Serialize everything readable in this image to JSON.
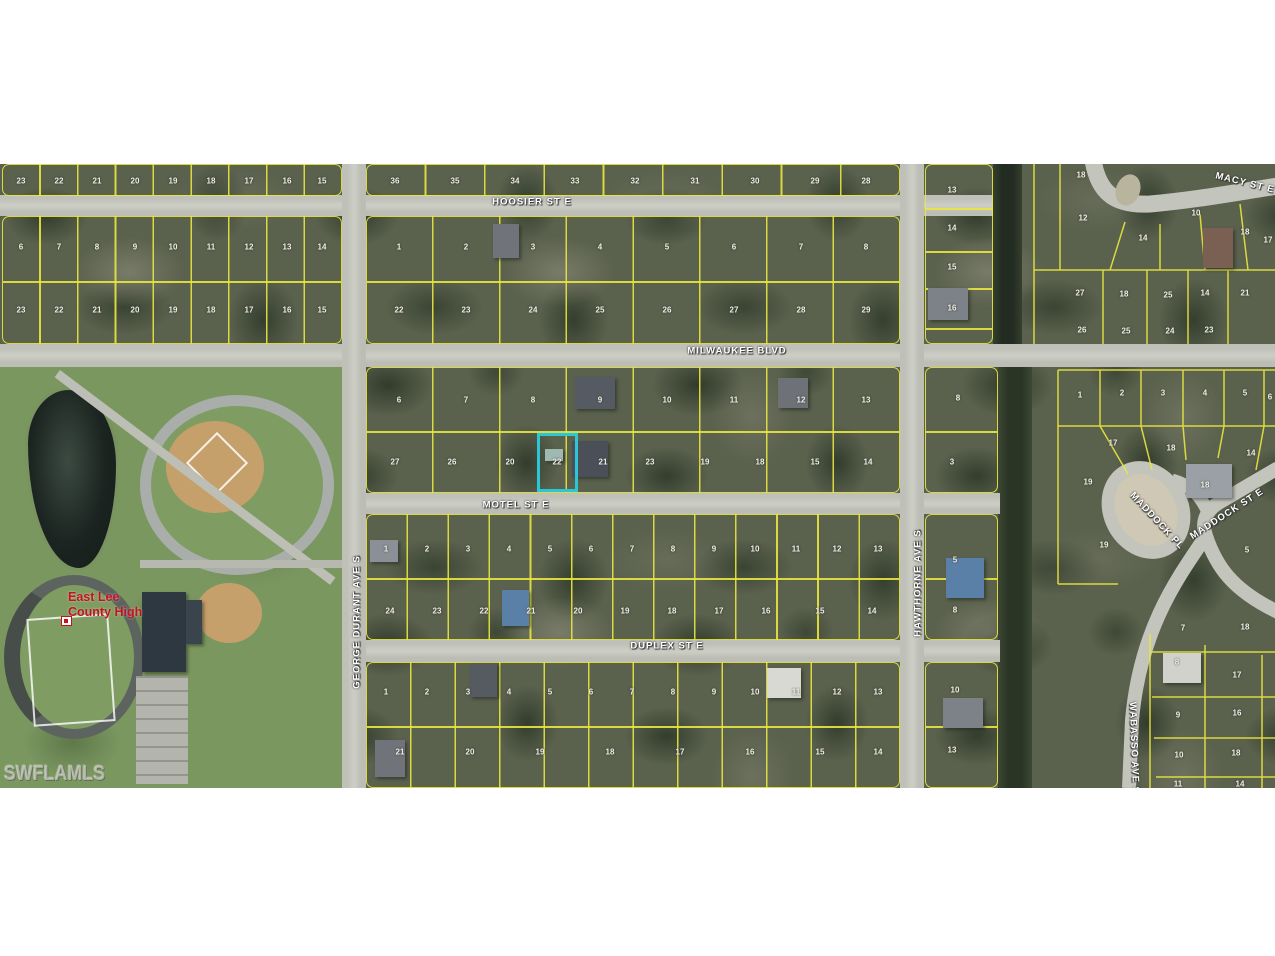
{
  "watermark": "SWFLAMLS",
  "school_label": {
    "line1": "East Lee",
    "line2": "County High"
  },
  "colors": {
    "parcel_line": "#e9e73f",
    "road": "#c3c5bc",
    "highlight": "#2cc7d6",
    "school_label_red": "#c5121f",
    "watermark_gray": "#d6d6d0",
    "scrub_green": "#5a614d",
    "campus_green": "#7b9760",
    "canal_dark": "#222c22"
  },
  "streets": [
    {
      "label": "HOOSIER ST E",
      "x": 532,
      "y": 202,
      "rot": 0
    },
    {
      "label": "MACY ST E",
      "x": 1245,
      "y": 183,
      "rot": 14
    },
    {
      "label": "MILWAUKEE BLVD",
      "x": 737,
      "y": 351,
      "rot": 0
    },
    {
      "label": "MOTEL ST E",
      "x": 516,
      "y": 505,
      "rot": 0
    },
    {
      "label": "DUPLEX ST E",
      "x": 667,
      "y": 646,
      "rot": 0
    },
    {
      "label": "GEORGE DURANT AVE S",
      "x": 357,
      "y": 622,
      "rot": -90
    },
    {
      "label": "HAWTHORNE AVE S",
      "x": 918,
      "y": 583,
      "rot": -90
    },
    {
      "label": "WABASSO AVE S",
      "x": 1134,
      "y": 748,
      "rot": 88
    },
    {
      "label": "MADDOCK PL",
      "x": 1157,
      "y": 521,
      "rot": 47
    },
    {
      "label": "MADDOCK ST E",
      "x": 1227,
      "y": 514,
      "rot": -33
    }
  ],
  "lot_numbers": [
    [
      21,
      181,
      "23"
    ],
    [
      59,
      181,
      "22"
    ],
    [
      97,
      181,
      "21"
    ],
    [
      135,
      181,
      "20"
    ],
    [
      173,
      181,
      "19"
    ],
    [
      211,
      181,
      "18"
    ],
    [
      249,
      181,
      "17"
    ],
    [
      287,
      181,
      "16"
    ],
    [
      322,
      181,
      "15"
    ],
    [
      395,
      181,
      "36"
    ],
    [
      455,
      181,
      "35"
    ],
    [
      515,
      181,
      "34"
    ],
    [
      575,
      181,
      "33"
    ],
    [
      635,
      181,
      "32"
    ],
    [
      695,
      181,
      "31"
    ],
    [
      755,
      181,
      "30"
    ],
    [
      815,
      181,
      "29"
    ],
    [
      866,
      181,
      "28"
    ],
    [
      21,
      247,
      "6"
    ],
    [
      59,
      247,
      "7"
    ],
    [
      97,
      247,
      "8"
    ],
    [
      135,
      247,
      "9"
    ],
    [
      173,
      247,
      "10"
    ],
    [
      211,
      247,
      "11"
    ],
    [
      249,
      247,
      "12"
    ],
    [
      287,
      247,
      "13"
    ],
    [
      322,
      247,
      "14"
    ],
    [
      399,
      247,
      "1"
    ],
    [
      466,
      247,
      "2"
    ],
    [
      533,
      247,
      "3"
    ],
    [
      600,
      247,
      "4"
    ],
    [
      667,
      247,
      "5"
    ],
    [
      734,
      247,
      "6"
    ],
    [
      801,
      247,
      "7"
    ],
    [
      866,
      247,
      "8"
    ],
    [
      21,
      310,
      "23"
    ],
    [
      59,
      310,
      "22"
    ],
    [
      97,
      310,
      "21"
    ],
    [
      135,
      310,
      "20"
    ],
    [
      173,
      310,
      "19"
    ],
    [
      211,
      310,
      "18"
    ],
    [
      249,
      310,
      "17"
    ],
    [
      287,
      310,
      "16"
    ],
    [
      322,
      310,
      "15"
    ],
    [
      399,
      310,
      "22"
    ],
    [
      466,
      310,
      "23"
    ],
    [
      533,
      310,
      "24"
    ],
    [
      600,
      310,
      "25"
    ],
    [
      667,
      310,
      "26"
    ],
    [
      734,
      310,
      "27"
    ],
    [
      801,
      310,
      "28"
    ],
    [
      866,
      310,
      "29"
    ],
    [
      952,
      190,
      "13"
    ],
    [
      952,
      228,
      "14"
    ],
    [
      952,
      267,
      "15"
    ],
    [
      952,
      308,
      "16"
    ],
    [
      1081,
      175,
      "18"
    ],
    [
      1083,
      218,
      "12"
    ],
    [
      1143,
      238,
      "14"
    ],
    [
      1196,
      213,
      "10"
    ],
    [
      1245,
      232,
      "18"
    ],
    [
      1268,
      240,
      "17"
    ],
    [
      1080,
      293,
      "27"
    ],
    [
      1124,
      294,
      "18"
    ],
    [
      1168,
      295,
      "25"
    ],
    [
      1205,
      293,
      "14"
    ],
    [
      1245,
      293,
      "21"
    ],
    [
      1082,
      330,
      "26"
    ],
    [
      1126,
      331,
      "25"
    ],
    [
      1170,
      331,
      "24"
    ],
    [
      1209,
      330,
      "23"
    ],
    [
      399,
      400,
      "6"
    ],
    [
      466,
      400,
      "7"
    ],
    [
      533,
      400,
      "8"
    ],
    [
      600,
      400,
      "9"
    ],
    [
      667,
      400,
      "10"
    ],
    [
      734,
      400,
      "11"
    ],
    [
      801,
      400,
      "12"
    ],
    [
      866,
      400,
      "13"
    ],
    [
      395,
      462,
      "27"
    ],
    [
      452,
      462,
      "26"
    ],
    [
      510,
      462,
      "20"
    ],
    [
      557,
      462,
      "22"
    ],
    [
      603,
      462,
      "21"
    ],
    [
      650,
      462,
      "23"
    ],
    [
      705,
      462,
      "19"
    ],
    [
      760,
      462,
      "18"
    ],
    [
      815,
      462,
      "15"
    ],
    [
      868,
      462,
      "14"
    ],
    [
      958,
      398,
      "8"
    ],
    [
      952,
      462,
      "3"
    ],
    [
      386,
      549,
      "1"
    ],
    [
      427,
      549,
      "2"
    ],
    [
      468,
      549,
      "3"
    ],
    [
      509,
      549,
      "4"
    ],
    [
      550,
      549,
      "5"
    ],
    [
      591,
      549,
      "6"
    ],
    [
      632,
      549,
      "7"
    ],
    [
      673,
      549,
      "8"
    ],
    [
      714,
      549,
      "9"
    ],
    [
      755,
      549,
      "10"
    ],
    [
      796,
      549,
      "11"
    ],
    [
      837,
      549,
      "12"
    ],
    [
      878,
      549,
      "13"
    ],
    [
      390,
      611,
      "24"
    ],
    [
      437,
      611,
      "23"
    ],
    [
      484,
      611,
      "22"
    ],
    [
      531,
      611,
      "21"
    ],
    [
      578,
      611,
      "20"
    ],
    [
      625,
      611,
      "19"
    ],
    [
      672,
      611,
      "18"
    ],
    [
      719,
      611,
      "17"
    ],
    [
      766,
      611,
      "16"
    ],
    [
      820,
      611,
      "15"
    ],
    [
      872,
      611,
      "14"
    ],
    [
      955,
      560,
      "5"
    ],
    [
      955,
      610,
      "8"
    ],
    [
      386,
      692,
      "1"
    ],
    [
      427,
      692,
      "2"
    ],
    [
      468,
      692,
      "3"
    ],
    [
      509,
      692,
      "4"
    ],
    [
      550,
      692,
      "5"
    ],
    [
      591,
      692,
      "6"
    ],
    [
      632,
      692,
      "7"
    ],
    [
      673,
      692,
      "8"
    ],
    [
      714,
      692,
      "9"
    ],
    [
      755,
      692,
      "10"
    ],
    [
      796,
      692,
      "11"
    ],
    [
      837,
      692,
      "12"
    ],
    [
      878,
      692,
      "13"
    ],
    [
      400,
      752,
      "21"
    ],
    [
      470,
      752,
      "20"
    ],
    [
      540,
      752,
      "19"
    ],
    [
      610,
      752,
      "18"
    ],
    [
      680,
      752,
      "17"
    ],
    [
      750,
      752,
      "16"
    ],
    [
      820,
      752,
      "15"
    ],
    [
      878,
      752,
      "14"
    ],
    [
      955,
      690,
      "10"
    ],
    [
      952,
      750,
      "13"
    ],
    [
      1080,
      395,
      "1"
    ],
    [
      1122,
      393,
      "2"
    ],
    [
      1163,
      393,
      "3"
    ],
    [
      1205,
      393,
      "4"
    ],
    [
      1245,
      393,
      "5"
    ],
    [
      1270,
      397,
      "6"
    ],
    [
      1113,
      443,
      "17"
    ],
    [
      1171,
      448,
      "18"
    ],
    [
      1251,
      453,
      "14"
    ],
    [
      1088,
      482,
      "19"
    ],
    [
      1205,
      485,
      "18"
    ],
    [
      1104,
      545,
      "19"
    ],
    [
      1247,
      550,
      "5"
    ],
    [
      1183,
      628,
      "7"
    ],
    [
      1245,
      627,
      "18"
    ],
    [
      1177,
      662,
      "8"
    ],
    [
      1237,
      675,
      "17"
    ],
    [
      1178,
      715,
      "9"
    ],
    [
      1237,
      713,
      "16"
    ],
    [
      1179,
      755,
      "10"
    ],
    [
      1236,
      753,
      "18"
    ],
    [
      1178,
      784,
      "11"
    ],
    [
      1240,
      784,
      "14"
    ]
  ],
  "buildings": [
    [
      493,
      224,
      26,
      34,
      "#70747a"
    ],
    [
      575,
      377,
      40,
      32,
      "#565b63"
    ],
    [
      778,
      378,
      30,
      30,
      "#6e7278"
    ],
    [
      572,
      441,
      36,
      36,
      "#4b5058"
    ],
    [
      545,
      449,
      18,
      12,
      "#9fb8b2"
    ],
    [
      502,
      590,
      27,
      36,
      "#5b80a8"
    ],
    [
      370,
      540,
      28,
      22,
      "#8b9097"
    ],
    [
      470,
      663,
      27,
      34,
      "#565b62"
    ],
    [
      767,
      668,
      34,
      30,
      "#d9d9d3"
    ],
    [
      375,
      740,
      30,
      37,
      "#70747a"
    ],
    [
      928,
      288,
      40,
      32,
      "#7d8288"
    ],
    [
      946,
      558,
      38,
      40,
      "#5b80a8"
    ],
    [
      943,
      698,
      40,
      30,
      "#7d8288"
    ],
    [
      1186,
      464,
      46,
      34,
      "#9aa0a6"
    ],
    [
      1163,
      653,
      38,
      30,
      "#d2d2cc"
    ],
    [
      1203,
      228,
      30,
      40,
      "#7a6052"
    ],
    [
      142,
      592,
      44,
      80,
      "#2e3841"
    ],
    [
      186,
      600,
      16,
      44,
      "#3a444d"
    ]
  ]
}
